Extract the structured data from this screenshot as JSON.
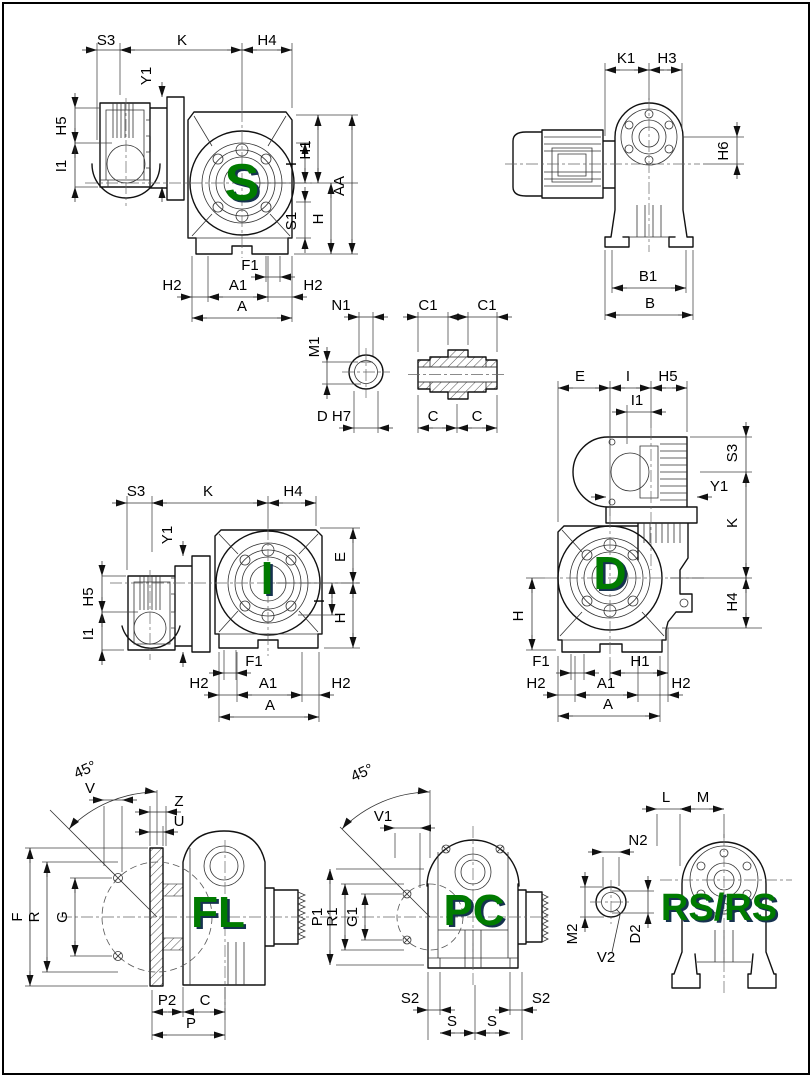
{
  "drawing": {
    "kind": "technical-dimension-drawing",
    "subject": "worm gearmotor mounting configurations",
    "background": "#ffffff",
    "line_color": "#1a1a1a",
    "label_green": "#007b00",
    "label_shadow": "#16324f"
  },
  "views": {
    "s": {
      "label": "S",
      "dims": [
        "S3",
        "K",
        "H4",
        "Y1",
        "H5",
        "I1",
        "I",
        "S1",
        "H1",
        "H",
        "AA",
        "F1",
        "H2",
        "A1",
        "H2",
        "A"
      ]
    },
    "side": {
      "dims": [
        "K1",
        "H3",
        "H6",
        "B1",
        "B"
      ]
    },
    "bore": {
      "dims": [
        "N1",
        "M1",
        "D H7"
      ]
    },
    "sleeve": {
      "dims": [
        "C1",
        "C1",
        "C",
        "C"
      ]
    },
    "d": {
      "label": "D",
      "dims": [
        "E",
        "I",
        "H5",
        "I1",
        "S3",
        "Y1",
        "K",
        "H4",
        "H",
        "F1",
        "H1",
        "H2",
        "A1",
        "H2",
        "A"
      ]
    },
    "i": {
      "label": "I",
      "dims": [
        "S3",
        "K",
        "H4",
        "Y1",
        "H5",
        "I1",
        "E",
        "I",
        "H",
        "F1",
        "H2",
        "A1",
        "H2",
        "A"
      ]
    },
    "fl": {
      "label": "FL",
      "dims": [
        "45°",
        "V",
        "Z",
        "U",
        "F",
        "R",
        "G",
        "P2",
        "C",
        "P"
      ]
    },
    "pc": {
      "label": "PC",
      "dims": [
        "45°",
        "V1",
        "P1",
        "R1",
        "G1",
        "S2",
        "S",
        "S",
        "S2"
      ]
    },
    "rs": {
      "label": "RS/RS",
      "dims": [
        "L",
        "M",
        "N2",
        "M2",
        "D2",
        "V2"
      ]
    }
  }
}
